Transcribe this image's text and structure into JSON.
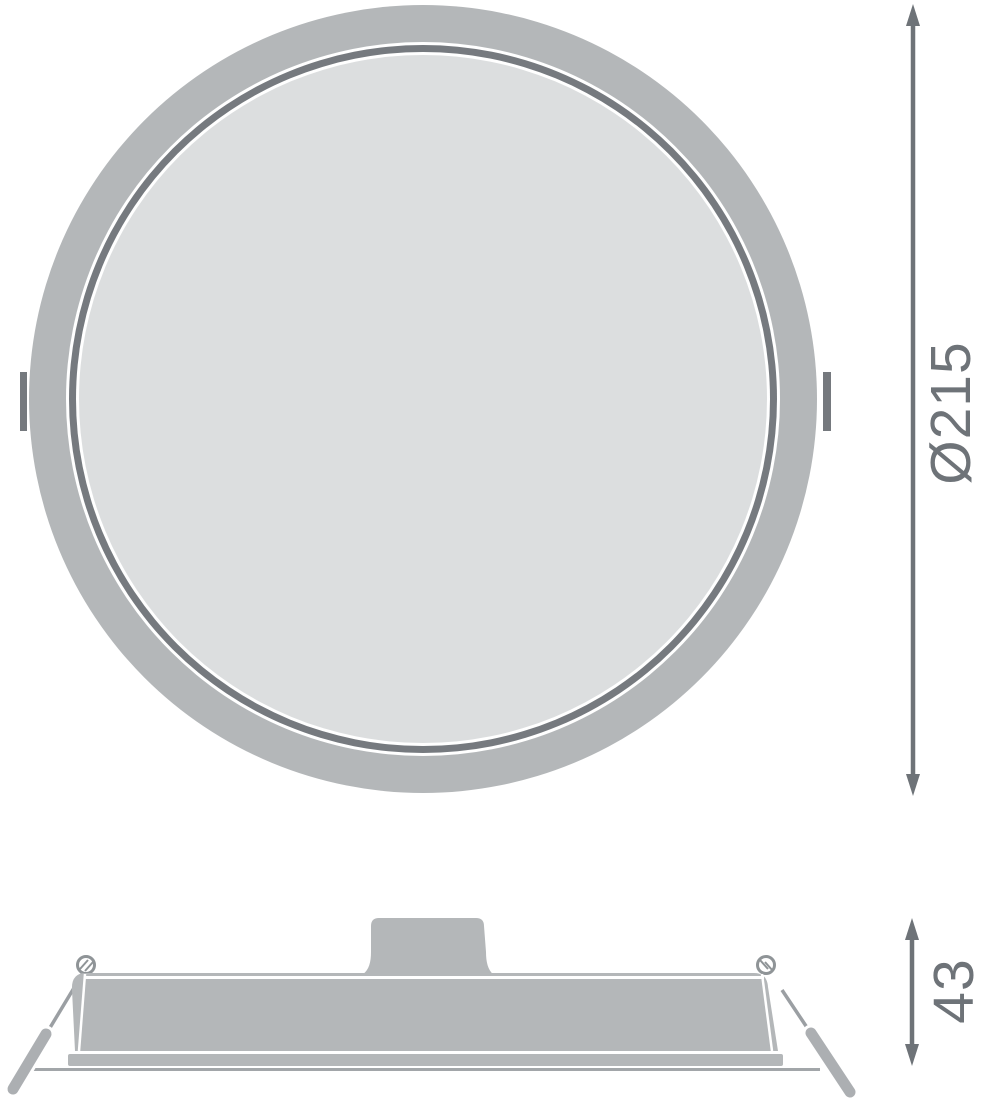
{
  "dimensions": {
    "diameter": {
      "label": "Ø215"
    },
    "height": {
      "label": "43"
    }
  },
  "colors": {
    "housing": "#b4b7b9",
    "diffuser": "#dcdedf",
    "groove": "#767a7f",
    "clip_tab": "#75797e",
    "dimension": "#6e7378",
    "clip_wire": "#9b9fa3",
    "clip_rod": "#acafb2",
    "coil": "#8f9497",
    "ceiling_line": "#a2a6a9",
    "background": "#ffffff"
  }
}
